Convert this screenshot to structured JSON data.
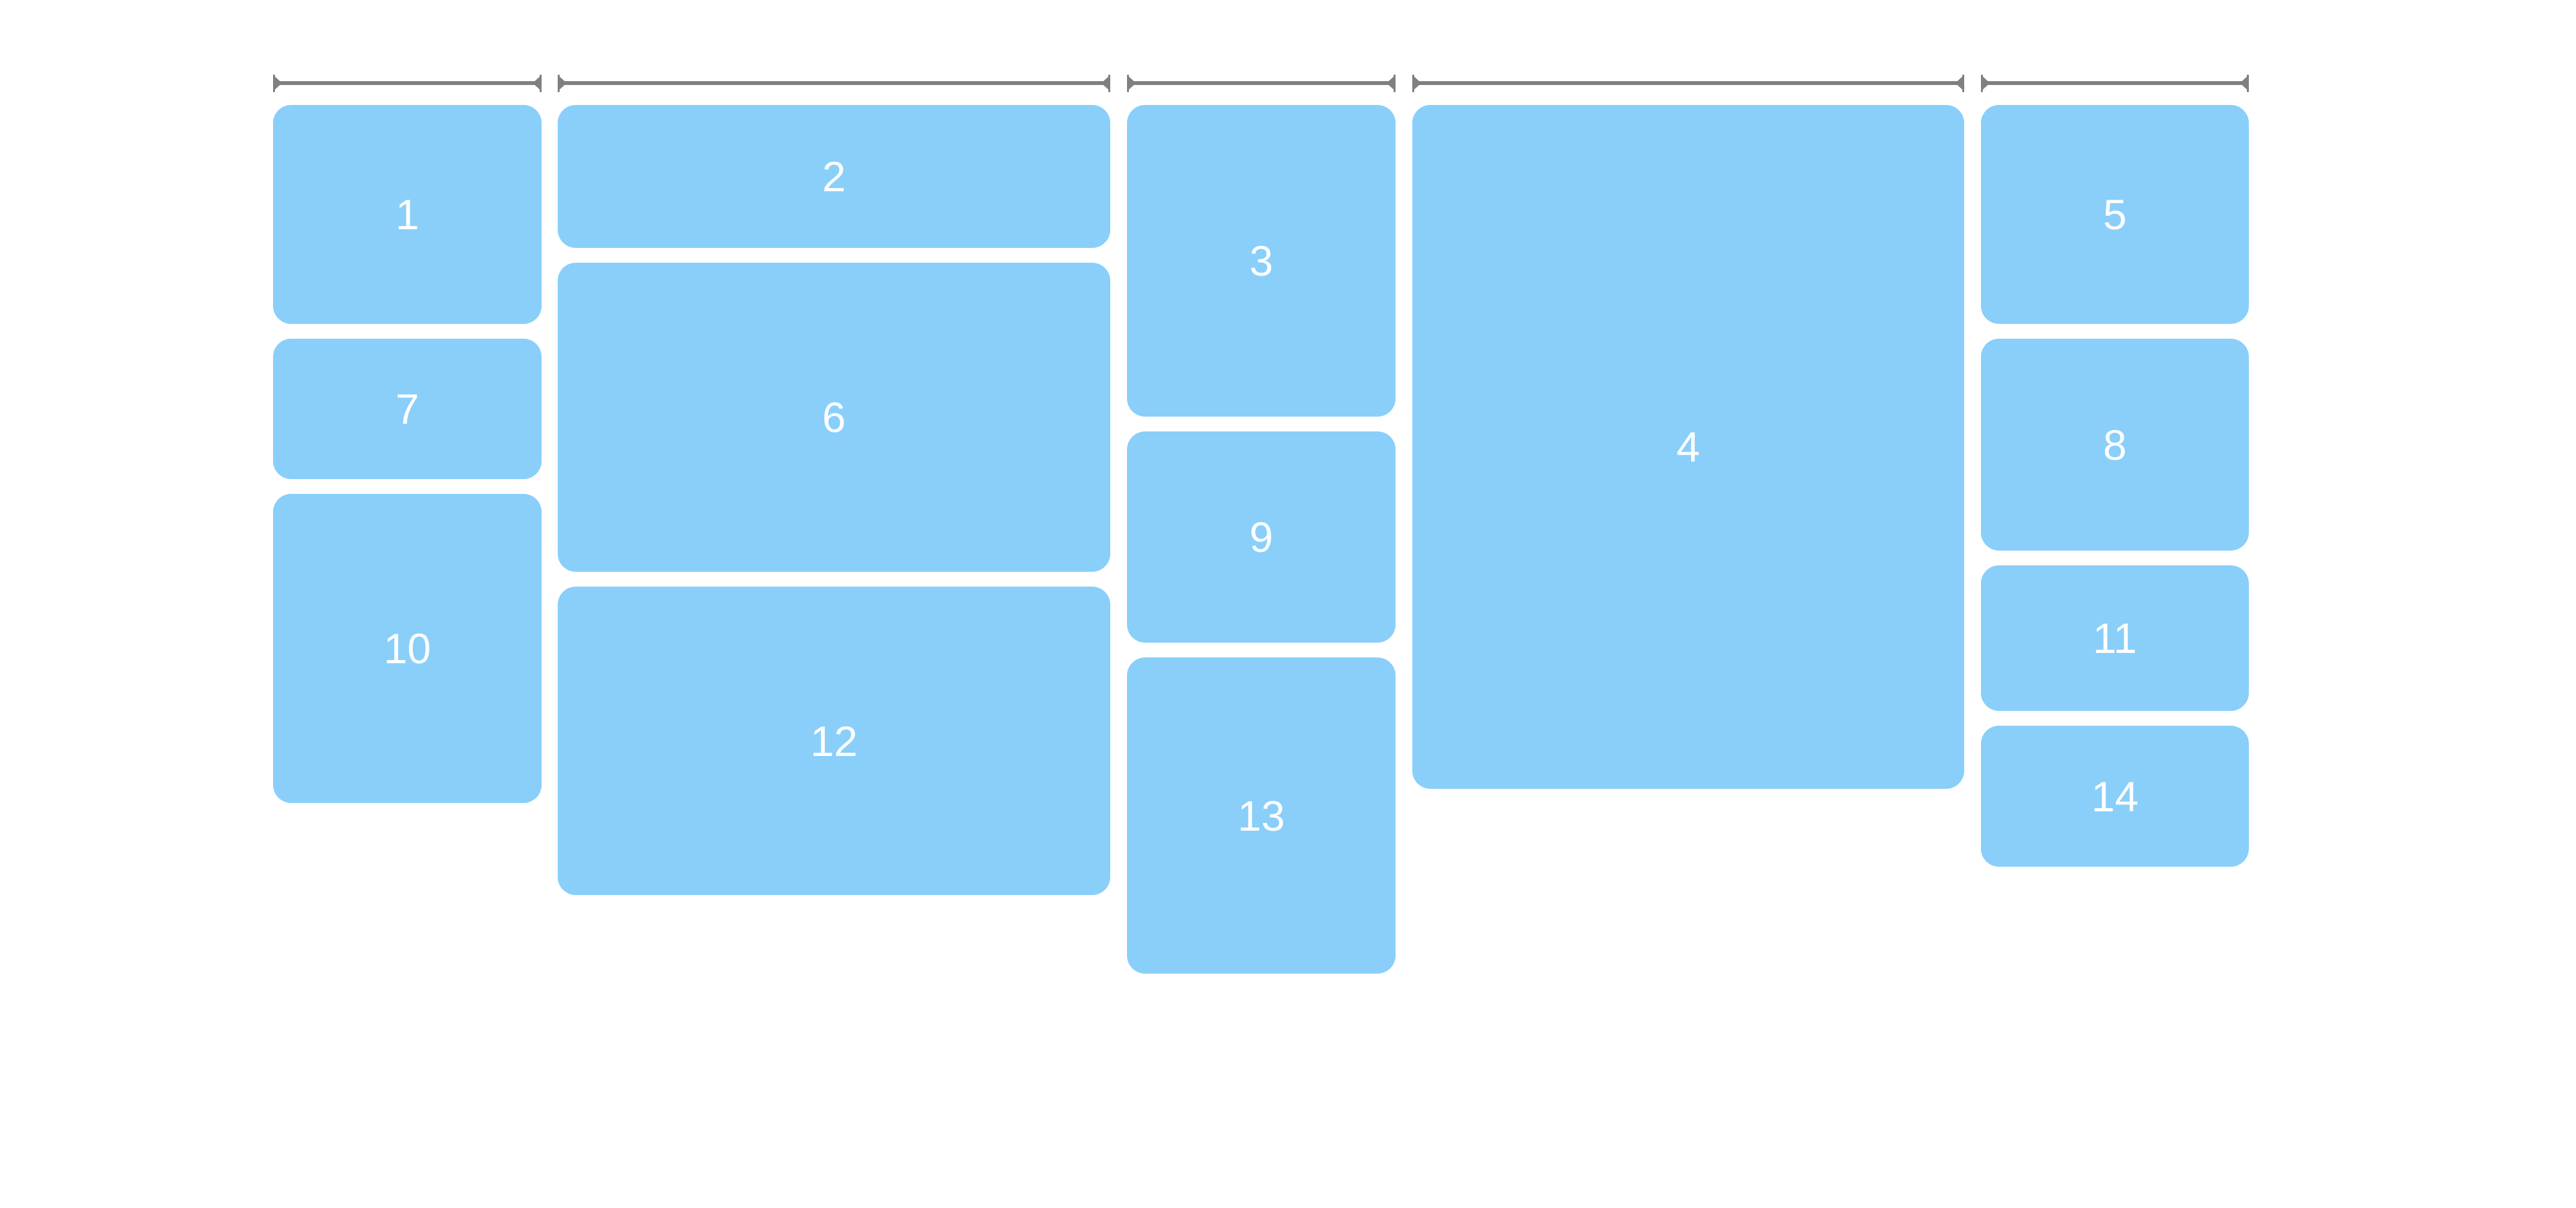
{
  "page": {
    "background_color": "#ffffff",
    "description": "masonry column layout demo with width rulers"
  },
  "palette": {
    "block_fill": "#89CFFA",
    "block_text": "#ffffff",
    "ruler_color": "#808080"
  },
  "rulers": [
    {
      "icon": "width-ruler-icon"
    },
    {
      "icon": "width-ruler-icon"
    },
    {
      "icon": "width-ruler-icon"
    },
    {
      "icon": "width-ruler-icon"
    },
    {
      "icon": "width-ruler-icon"
    }
  ],
  "masonry": {
    "columns": [
      {
        "blocks": [
          {
            "label": "1"
          },
          {
            "label": "7"
          },
          {
            "label": "10"
          }
        ]
      },
      {
        "blocks": [
          {
            "label": "2"
          },
          {
            "label": "6"
          },
          {
            "label": "12"
          }
        ]
      },
      {
        "blocks": [
          {
            "label": "3"
          },
          {
            "label": "9"
          },
          {
            "label": "13"
          }
        ]
      },
      {
        "blocks": [
          {
            "label": "4"
          }
        ]
      },
      {
        "blocks": [
          {
            "label": "5"
          },
          {
            "label": "8"
          },
          {
            "label": "11"
          },
          {
            "label": "14"
          }
        ]
      }
    ]
  }
}
